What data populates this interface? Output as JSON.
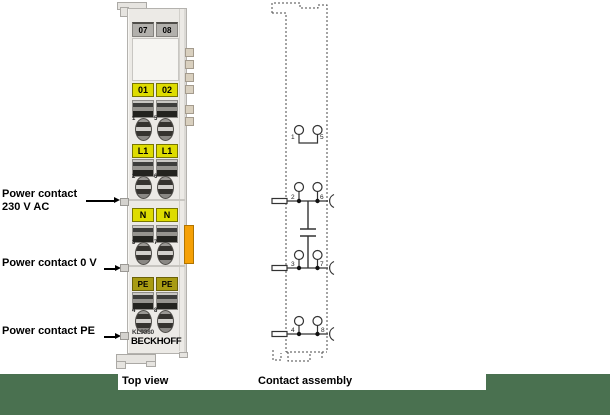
{
  "colors": {
    "green_band": "#4a7150",
    "yellow": "#dedc00",
    "pe_yellow": "#a89b12",
    "orange": "#f5a005",
    "gray_label": "#b2b0ac",
    "body": "#eceae6"
  },
  "annotations": {
    "power_230": {
      "line1": "Power contact",
      "line2": "230 V AC"
    },
    "power_0v": {
      "text": "Power contact 0 V"
    },
    "power_pe": {
      "text": "Power contact PE"
    }
  },
  "module": {
    "model": "KL9380",
    "brand": "BECKHOFF",
    "top_labels": [
      "07",
      "08"
    ],
    "rows": [
      {
        "left": "01",
        "right": "02",
        "num_left": "1",
        "num_right": "5"
      },
      {
        "left": "L1",
        "right": "L1",
        "num_left": "2",
        "num_right": "6"
      },
      {
        "left": "N",
        "right": "N",
        "num_left": "3",
        "num_right": "7"
      },
      {
        "left": "PE",
        "right": "PE",
        "num_left": "4",
        "num_right": "8"
      }
    ]
  },
  "schematic": {
    "contact_numbers": [
      [
        "1",
        "5"
      ],
      [
        "2",
        "6"
      ],
      [
        "3",
        "7"
      ],
      [
        "4",
        "8"
      ]
    ]
  },
  "captions": {
    "left": "Top view",
    "right": "Contact assembly"
  }
}
